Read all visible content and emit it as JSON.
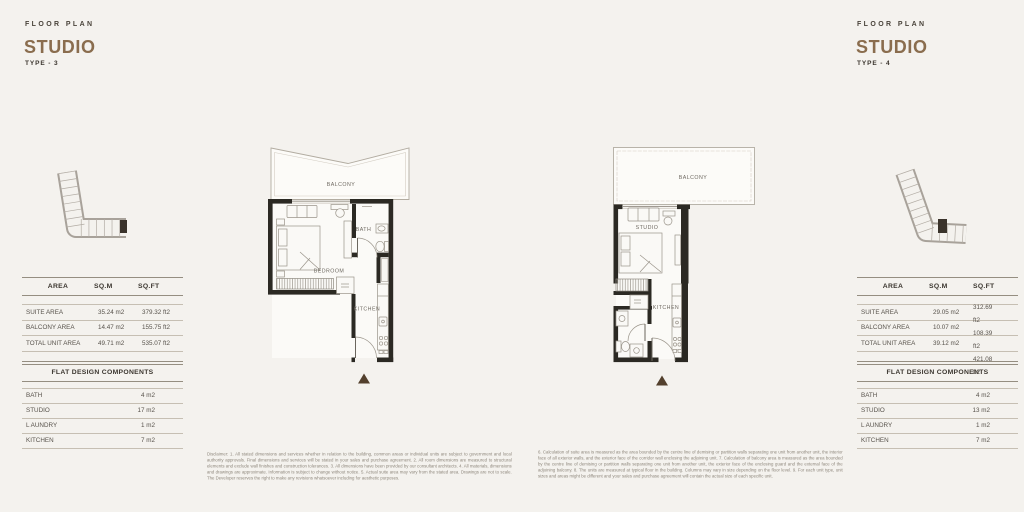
{
  "left": {
    "eyebrow": "FLOOR PLAN",
    "title": "STUDIO",
    "type": "TYPE - 3",
    "table": {
      "col_area": "AREA",
      "col_sqm": "SQ.M",
      "col_sqft": "SQ.FT",
      "rows": [
        {
          "label": "SUITE AREA",
          "sqm": "35.24 m2",
          "sqft": "379.32 ft2"
        },
        {
          "label": "BALCONY AREA",
          "sqm": "14.47 m2",
          "sqft": "155.75 ft2"
        },
        {
          "label": "TOTAL UNIT AREA",
          "sqm": "49.71 m2",
          "sqft": "535.07 ft2"
        }
      ],
      "components_title": "FLAT DESIGN COMPONENTS",
      "components": [
        {
          "label": "BATH",
          "value": "4 m2"
        },
        {
          "label": "STUDIO",
          "value": "17 m2"
        },
        {
          "label": "L AUNDRY",
          "value": "1 m2"
        },
        {
          "label": "KITCHEN",
          "value": "7 m2"
        }
      ]
    },
    "plan": {
      "balcony": "BALCONY",
      "bath": "BATH",
      "room": "BEDROOM",
      "kitchen": "KITCHEN"
    },
    "disclaimer": "Disclaimer: 1. All stated dimensions and services whether in relation to the building, common areas or individual units are subject to government and local authority approvals. Final dimensions and services will be stated in your sales and purchase agreement. 2. All room dimensions are measured to structural elements and exclude wall finishes and construction tolerances. 3. All dimensions have been provided by our consultant architects. 4. All materials, dimensions and drawings are approximate. Information is subject to change without notice. 5. Actual suite area may vary from the stated area. Drawings are not to scale. The Developer reserves the right to make any revisions whatsoever including for aesthetic purposes."
  },
  "right": {
    "eyebrow": "FLOOR PLAN",
    "title": "STUDIO",
    "type": "TYPE - 4",
    "table": {
      "col_area": "AREA",
      "col_sqm": "SQ.M",
      "col_sqft": "SQ.FT",
      "rows": [
        {
          "label": "SUITE AREA",
          "sqm": "29.05 m2"
        },
        {
          "label": "BALCONY AREA",
          "sqm": "10.07 m2"
        },
        {
          "label": "TOTAL UNIT AREA",
          "sqm": "39.12 m2"
        }
      ],
      "sqft_lines": [
        "312.69",
        "ft2",
        "108.39",
        "ft2",
        "421.08",
        "ft2"
      ],
      "components_title": "FLAT DESIGN COMPONENTS",
      "components": [
        {
          "label": "BATH",
          "value": "4 m2"
        },
        {
          "label": "STUDIO",
          "value": "13 m2"
        },
        {
          "label": "L AUNDRY",
          "value": "1 m2"
        },
        {
          "label": "KITCHEN",
          "value": "7 m2"
        }
      ]
    },
    "plan": {
      "balcony": "BALCONY",
      "room": "STUDIO",
      "kitchen": "KITCHEN"
    },
    "disclaimer": "6. Calculation of suite area is measured as the area bounded by the centre line of demising or partition walls separating one unit from another unit, the interior face of all exterior walls, and the exterior face of the corridor wall enclosing the adjoining unit. 7. Calculation of balcony area is measured as the area bounded by the centre line of demising or partition walls separating one unit from another unit, the exterior face of the enclosing guard and the external face of the adjoining balcony. 8. The units are measured at typical floor in the building. Columns may vary in size depending on the floor level. 9. For each unit type, unit sizes and areas might be different and your sales and purchase agreement will contain the actual size of each specific unit."
  },
  "icons": {
    "key_plan": "building-outline-with-unit-highlight",
    "unit_marker": "triangle-up"
  },
  "colors": {
    "background": "#f4f2ee",
    "accent_title": "#8a6d4e",
    "wall": "#2b2923",
    "table_rule": "#958e81",
    "marker_triangle": "#53402d",
    "plan_line": "#9a948a",
    "text_dark": "#3b362f",
    "text_mid": "#57524b",
    "disclaimer_text": "#8f887d"
  }
}
